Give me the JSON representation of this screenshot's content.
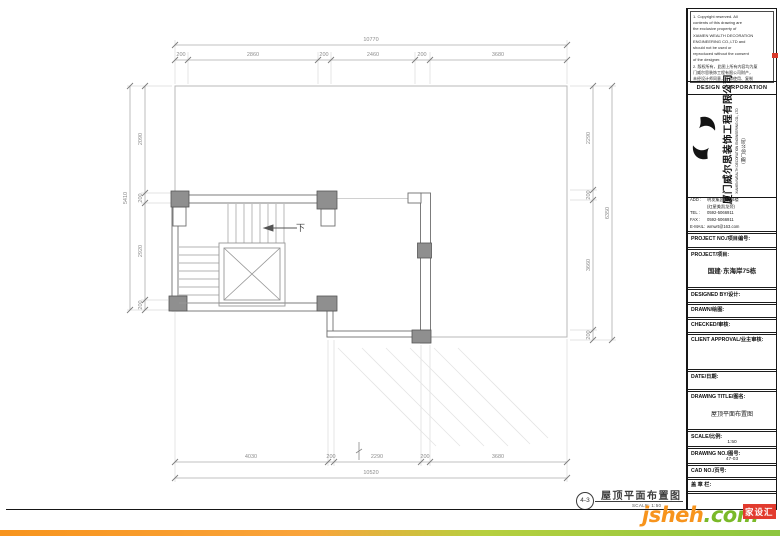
{
  "titleblock": {
    "notes": "1. Copyright reserved. All\ncontents of this drawing are\nthe exclusive property of\nXIAMEN WEALTH DECORATION\nENGINEERING CO.,LTD and\nshould not be used or\nreproduced without the consent\nof the designer.\n2. 版权所有，此图上所有内容均为厦\n门威尔思装饰工程有限公司财产，\n未经设计师同意，不得使用、复制\n或转印本图纸。\n3. All dimensions shall be\nverified by the contractor on\nsite prior to the commencement\nof work.\n4. 施工单位必须核对现场尺寸，如有\n不符请及时通知设计师。",
    "corp_bar": "DESIGN CORPORATION",
    "company_cn": "厦门威尔思装饰工程有限公司",
    "company_en": "XIAMEN WEALTH DECORATION ENGINEERING CO., LTD",
    "company_branch": "（厦门总公司）",
    "contact": [
      {
        "label": "ADD :",
        "value": "明发集团大厦6楼\n(红星美凯龙旁)"
      },
      {
        "label": "TEL :",
        "value": "0592-5066911"
      },
      {
        "label": "FAX :",
        "value": "0592-5066911"
      },
      {
        "label": "E-MAIL:",
        "value": "wmwrt@163.com"
      }
    ],
    "fields": [
      {
        "label": "PROJECT NO./项目编号:",
        "value": ""
      },
      {
        "label": "PROJECT/项目:",
        "value": "国建·东海岸75栋"
      },
      {
        "label": "DESIGNED BY/设计:",
        "value": ""
      },
      {
        "label": "DRAWN/绘图:",
        "value": ""
      },
      {
        "label": "CHECKED/审核:",
        "value": ""
      },
      {
        "label": "CLIENT APPROVAL/业主审核:",
        "value": ""
      },
      {
        "label": "DATE/日期:",
        "value": ""
      },
      {
        "label": "DRAWING TITLE/图名:",
        "value": "屋顶平面布置图"
      },
      {
        "label": "SCALE/比例:",
        "value": "1:50"
      },
      {
        "label": "DRAWING NO./图号:",
        "value": "47-03"
      },
      {
        "label": "CAD NO./页号:",
        "value": ""
      },
      {
        "label": "盖 章 栏:",
        "value": ""
      }
    ]
  },
  "plan": {
    "stair_down_label": "下",
    "dims": {
      "top_total": "10770",
      "top_segments": [
        "200",
        "2860",
        "200",
        "2460",
        "200",
        "3680"
      ],
      "bottom_segments": [
        "4030",
        "200",
        "2290",
        "200",
        "3680"
      ],
      "bottom_total": "10520",
      "left_total": "5410",
      "left_segments": [
        "2090",
        "200",
        "2920",
        "200"
      ],
      "right_segments": [
        "2290",
        "200",
        "3660",
        "200"
      ],
      "right_total": "6350"
    }
  },
  "footer": {
    "sheet_no": "4-3",
    "drawing_title": "屋顶平面布置图",
    "scale_text": "SCALE: 1:50"
  },
  "watermark": {
    "name": "jsheh",
    "tld": ".com",
    "badge": "家设汇"
  },
  "colors": {
    "accent_orange": "#f7941d",
    "accent_green": "#8dc63f",
    "badge_red": "#e23b2e",
    "column_gray": "#8f8f8f"
  }
}
